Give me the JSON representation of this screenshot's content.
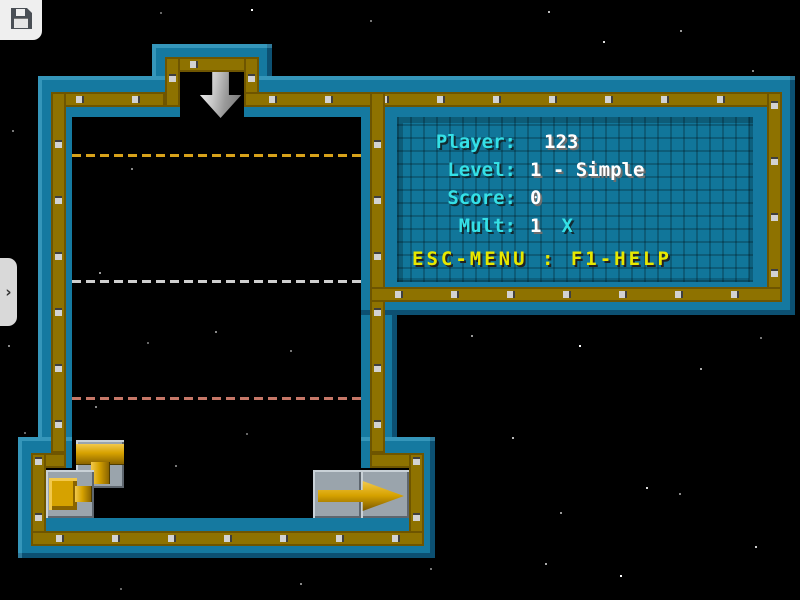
{
  "app": {
    "save_icon": "floppy-disk",
    "drawer_handle": "›",
    "drop_arrow_icon": "down-arrow"
  },
  "hud": {
    "rows": [
      {
        "label": "Player:",
        "value": "123"
      },
      {
        "label": "Level:",
        "value": "1 - Simple"
      },
      {
        "label": "Score:",
        "value": "0"
      },
      {
        "label": "Mult:",
        "value": "1",
        "suffix": "X"
      }
    ],
    "footer": "ESC-MENU : F1-HELP"
  },
  "board": {
    "guide_lines": [
      {
        "name": "upper",
        "color": "#D8A21A",
        "y": 155
      },
      {
        "name": "middle",
        "color": "#CFCFCF",
        "y": 281
      },
      {
        "name": "lower",
        "color": "#C67767",
        "y": 398
      }
    ],
    "pieces": [
      {
        "name": "tee-down-pipe"
      },
      {
        "name": "start-cap-pipe"
      },
      {
        "name": "end-arrow-pipe"
      }
    ]
  },
  "colors": {
    "wall_teal": "#1579A0",
    "wall_gold": "#8E7200",
    "panel_teal": "#11769A",
    "pipe_gold": "#D6A200",
    "text_cyan": "#35E0E6",
    "text_white": "#FFFFFF",
    "text_yellow": "#E8E800",
    "background": "#000000"
  }
}
